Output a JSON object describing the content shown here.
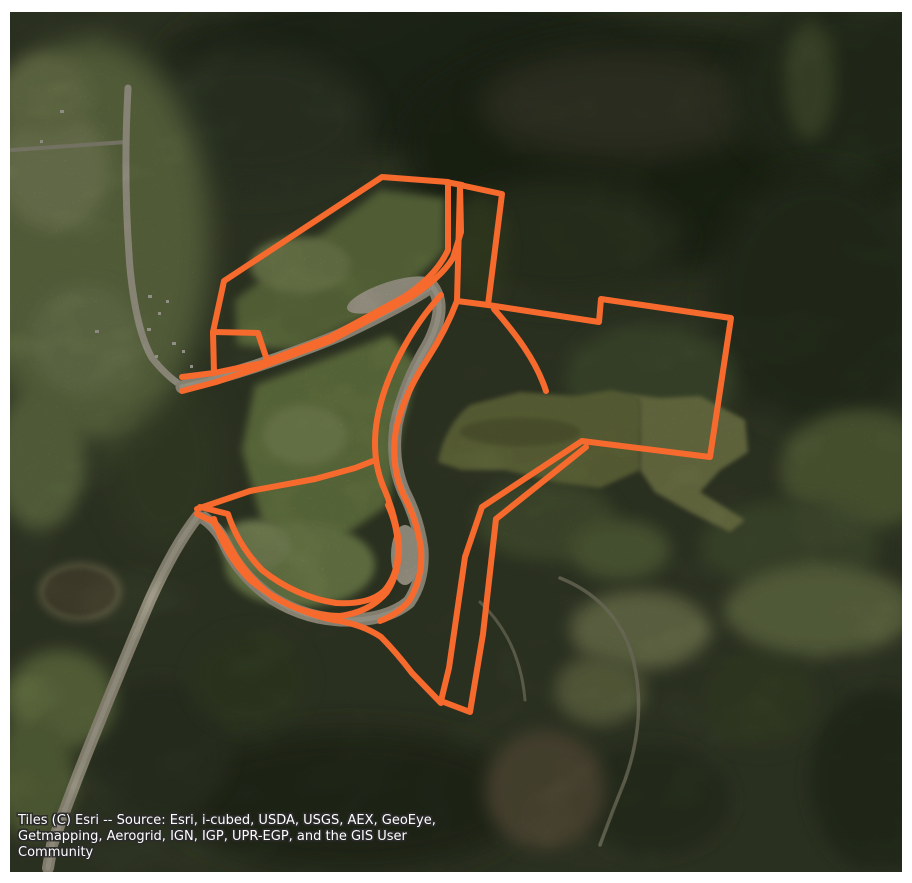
{
  "map": {
    "basemap_name": "Esri World Imagery satellite tiles",
    "attribution_lines": [
      "Tiles (C) Esri -- Source: Esri, i-cubed, USDA, USGS, AEX, GeoEye,",
      "Getmapping, Aerogrid, IGN, IGP, UPR-EGP, and the GIS User",
      "Community"
    ],
    "overlay": {
      "label": "property-boundary-polygon",
      "stroke_color": "#F76A2E",
      "stroke_width": "6",
      "paths": {
        "top_left_parcel": "M 382 177 L 448 182 L 448 250 Q 436 276 404 297 L 330 337 L 262 363 L 214 373 L 213 332 L 224 281 Z",
        "top_edge_link": "M 446 182 L 462 185",
        "left_notch_step": "M 213 332 L 258 333 L 266 357",
        "nw_bank_west_end": "M 182 377 L 214 373",
        "lane_and_se_bank": "M 460 185 L 461 232 L 453 258 Q 441 278 408 299 L 330 341 L 258 368 L 216 382 L 182 391",
        "top_right_parcel": "M 460 185 L 502 194 L 488 305 L 457 301 Z",
        "right_block_and_strip": "M 488 305 L 599 322 L 601 299 L 731 318 L 710 457 L 582 441 L 482 507 L 465 557 L 449 668 L 441 701 L 470 712 L 483 634 L 496 519 L 586 447",
        "spur_line": "M 494 309 C 515 333 536 360 546 391",
        "sbend_east_bank": "M 457 301 Q 446 330 428 358 Q 403 396 396 430 Q 390 466 404 496 Q 417 520 421 549 Q 423 578 409 601 Q 398 614 380 621",
        "sbend_west_bank": "M 441 295 Q 420 318 404 347 Q 383 385 377 420 Q 371 456 383 486 Q 395 513 399 543 Q 400 572 387 592 Q 370 612 340 616 Q 305 616 272 596 Q 247 577 232 550 Q 222 532 212 521 L 197 514",
        "loop_outer": "M 214 519 Q 224 553 250 580 Q 288 610 333 620 Q 362 624 381 637 Q 396 652 412 673 L 441 703",
        "loop_inner": "M 200 507 L 228 514 Q 238 545 262 570 Q 296 597 336 603 Q 370 605 385 590 Q 398 574 398 551 Q 398 527 388 505",
        "bottom_left_parcel_north": "M 197 509 L 250 491 L 315 479 L 355 468 L 373 461"
      }
    }
  }
}
